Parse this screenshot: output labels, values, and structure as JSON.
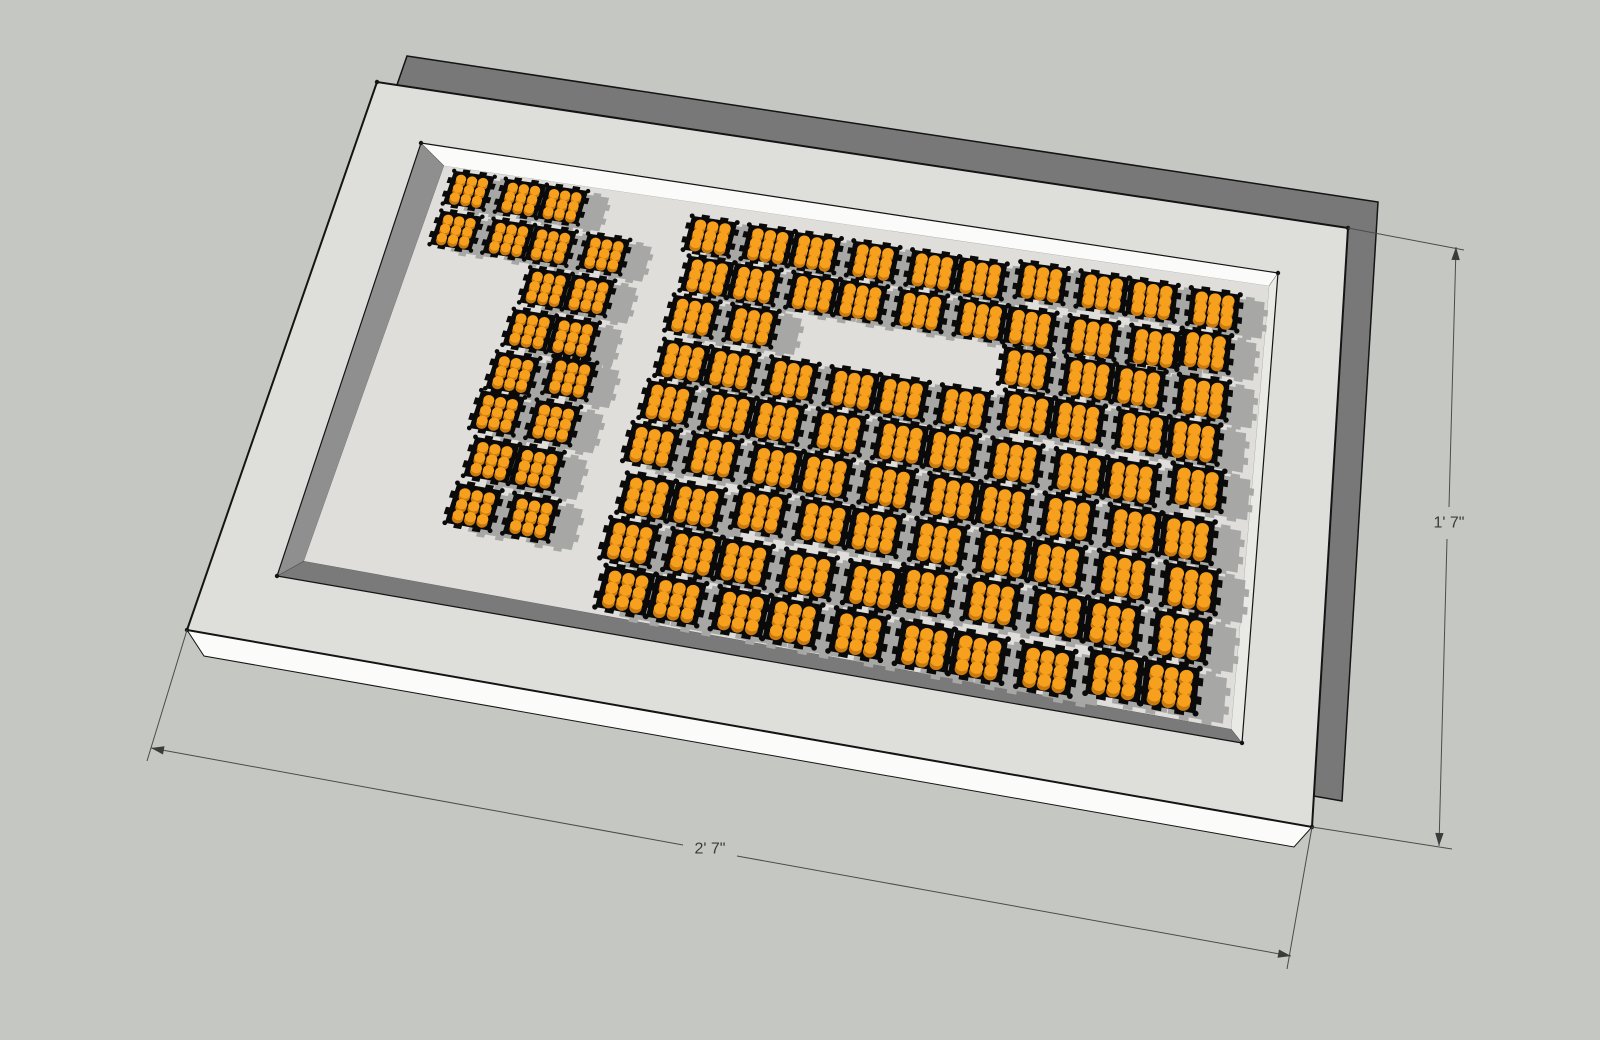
{
  "app": {
    "name": "3d-model-viewport",
    "view": "perspective"
  },
  "canvas": {
    "width": 1600,
    "height": 1040,
    "background": "#c5c8c2"
  },
  "model": {
    "name": "led-matrix-sign-panel",
    "displayed_pattern": "16",
    "module_count": 105,
    "slab": {
      "front": [
        [
          377,
          82
        ],
        [
          1348,
          228
        ],
        [
          1312,
          827
        ],
        [
          187,
          630
        ]
      ],
      "back_offset": [
        30,
        -26
      ],
      "front_color": "#dededa",
      "side_dark_color": "#787878",
      "bottom_side": [
        [
          187,
          630
        ],
        [
          1312,
          827
        ],
        [
          1294,
          847
        ],
        [
          204,
          656
        ]
      ],
      "bottom_side_color": "#fbfbfa",
      "edge_color": "#141414"
    },
    "recess": {
      "rim": [
        [
          421,
          143
        ],
        [
          1278,
          273
        ],
        [
          1242,
          743
        ],
        [
          277,
          576
        ]
      ],
      "floor": [
        [
          444,
          166
        ],
        [
          1269,
          286
        ],
        [
          1231,
          729
        ],
        [
          304,
          561
        ]
      ],
      "floor_color": "#dfdedb",
      "wall_colors": {
        "top": "#fbfbfa",
        "right": "#e9e9e6",
        "bottom": "#7a7a7a",
        "left": "#8f8f8f"
      }
    },
    "modules": {
      "body_color": "#0a0a0a",
      "shadow_color": "#a7a7a5",
      "led_top_color": "#f7a01e",
      "led_side_color": "#c87a10",
      "leds_per_module": "3x3",
      "shadow_uv_offset": [
        0.028,
        0.01
      ]
    },
    "clusters": [
      {
        "name": "digit-1",
        "u0": 0.012,
        "v0": 0.006,
        "cell_u": 0.0615,
        "cell_v": 0.1085,
        "rows": [
          "1110",
          "1111",
          "0011",
          "0011",
          "0011",
          "0011",
          "0011",
          "0011"
        ]
      },
      {
        "name": "digit-6",
        "u0": 0.318,
        "v0": 0.028,
        "cell_u": 0.0655,
        "cell_v": 0.1075,
        "rows": [
          "1111111111",
          "1111111111",
          "1100001111",
          "1111111111",
          "1111111111",
          "1111111111",
          "1111111111",
          "1111111111",
          "1111111111"
        ]
      }
    ]
  },
  "dimensions": {
    "width_label": "2' 7\"",
    "height_label": "1' 7\"",
    "line_color": "#4b4b4b",
    "text_color": "#3b3b3b",
    "font_size": 16,
    "width_dim": {
      "extensions": [
        [
          [
            187,
            630
          ],
          [
            147,
            761
          ]
        ],
        [
          [
            1312,
            827
          ],
          [
            1287,
            969
          ]
        ]
      ],
      "segments": [
        [
          [
            151,
            748
          ],
          [
            683,
            845
          ]
        ],
        [
          [
            737,
            856
          ],
          [
            1291,
            956
          ]
        ]
      ],
      "arrows": [
        [
          [
            151,
            748
          ],
          [
            1291,
            956
          ]
        ],
        [
          [
            1291,
            956
          ],
          [
            151,
            748
          ]
        ]
      ],
      "label_pos": [
        710,
        849
      ]
    },
    "height_dim": {
      "extensions": [
        [
          [
            1348,
            228
          ],
          [
            1464,
            250
          ]
        ],
        [
          [
            1312,
            827
          ],
          [
            1452,
            849
          ]
        ]
      ],
      "segments": [
        [
          [
            1456,
            247
          ],
          [
            1449,
            507
          ]
        ],
        [
          [
            1447,
            539
          ],
          [
            1439,
            846
          ]
        ]
      ],
      "arrows": [
        [
          [
            1456,
            247
          ],
          [
            1439,
            846
          ]
        ],
        [
          [
            1439,
            846
          ],
          [
            1456,
            247
          ]
        ]
      ],
      "label_pos": [
        1449,
        523
      ]
    }
  }
}
